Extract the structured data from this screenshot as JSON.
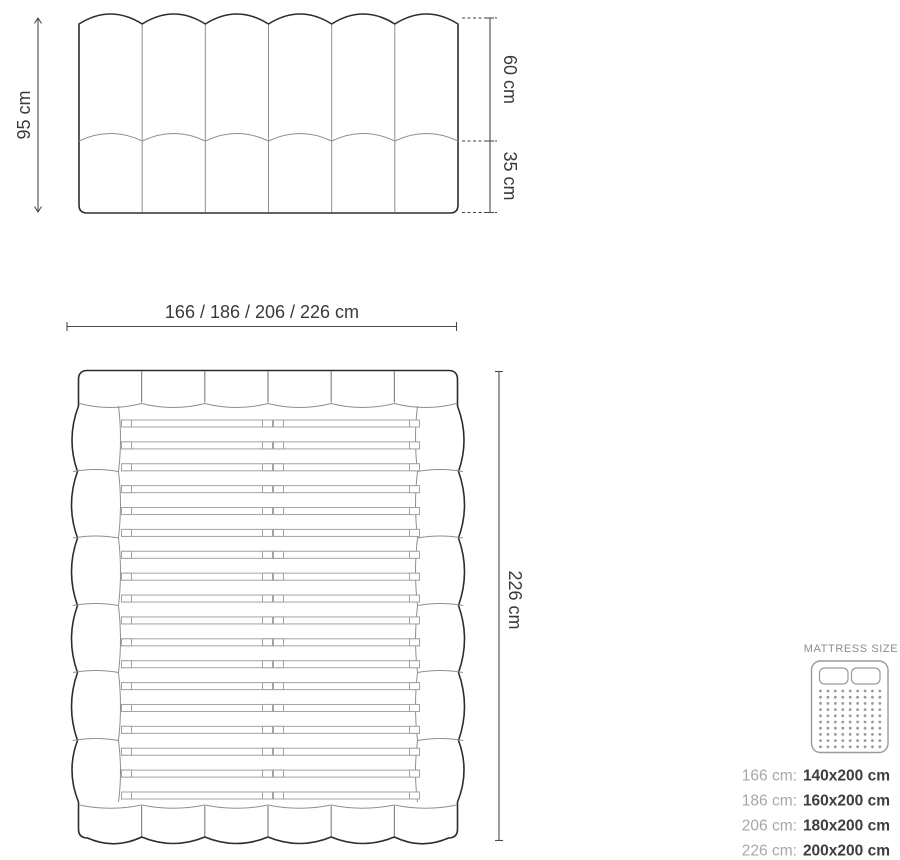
{
  "colors": {
    "outline": "#2d2d2d",
    "thin_line": "#8f8f8f",
    "slat_line": "#a3a3a3",
    "dim_line": "#4a4a4a",
    "dim_text": "#3a3a3a",
    "legend_title": "#8c8c8c",
    "legend_muted": "#a7a7a7",
    "legend_value": "#3d3d3d"
  },
  "headboard_front_view": {
    "panels": 6,
    "total_height_label": "95 cm",
    "upper_section_label": "60 cm",
    "lower_section_label": "35 cm"
  },
  "bed_top_view": {
    "width_label": "166 / 186 / 206 / 226 cm",
    "length_label": "226 cm",
    "headboard_segments": 6,
    "footboard_segments": 6,
    "rail_segments": 6,
    "slat_rows": 18
  },
  "legend": {
    "title": "MATTRESS SIZE",
    "sizes": [
      {
        "width": "166 cm:",
        "mattress": "140x200 cm"
      },
      {
        "width": "186 cm:",
        "mattress": "160x200 cm"
      },
      {
        "width": "206 cm:",
        "mattress": "180x200 cm"
      },
      {
        "width": "226 cm:",
        "mattress": "200x200 cm"
      }
    ]
  }
}
